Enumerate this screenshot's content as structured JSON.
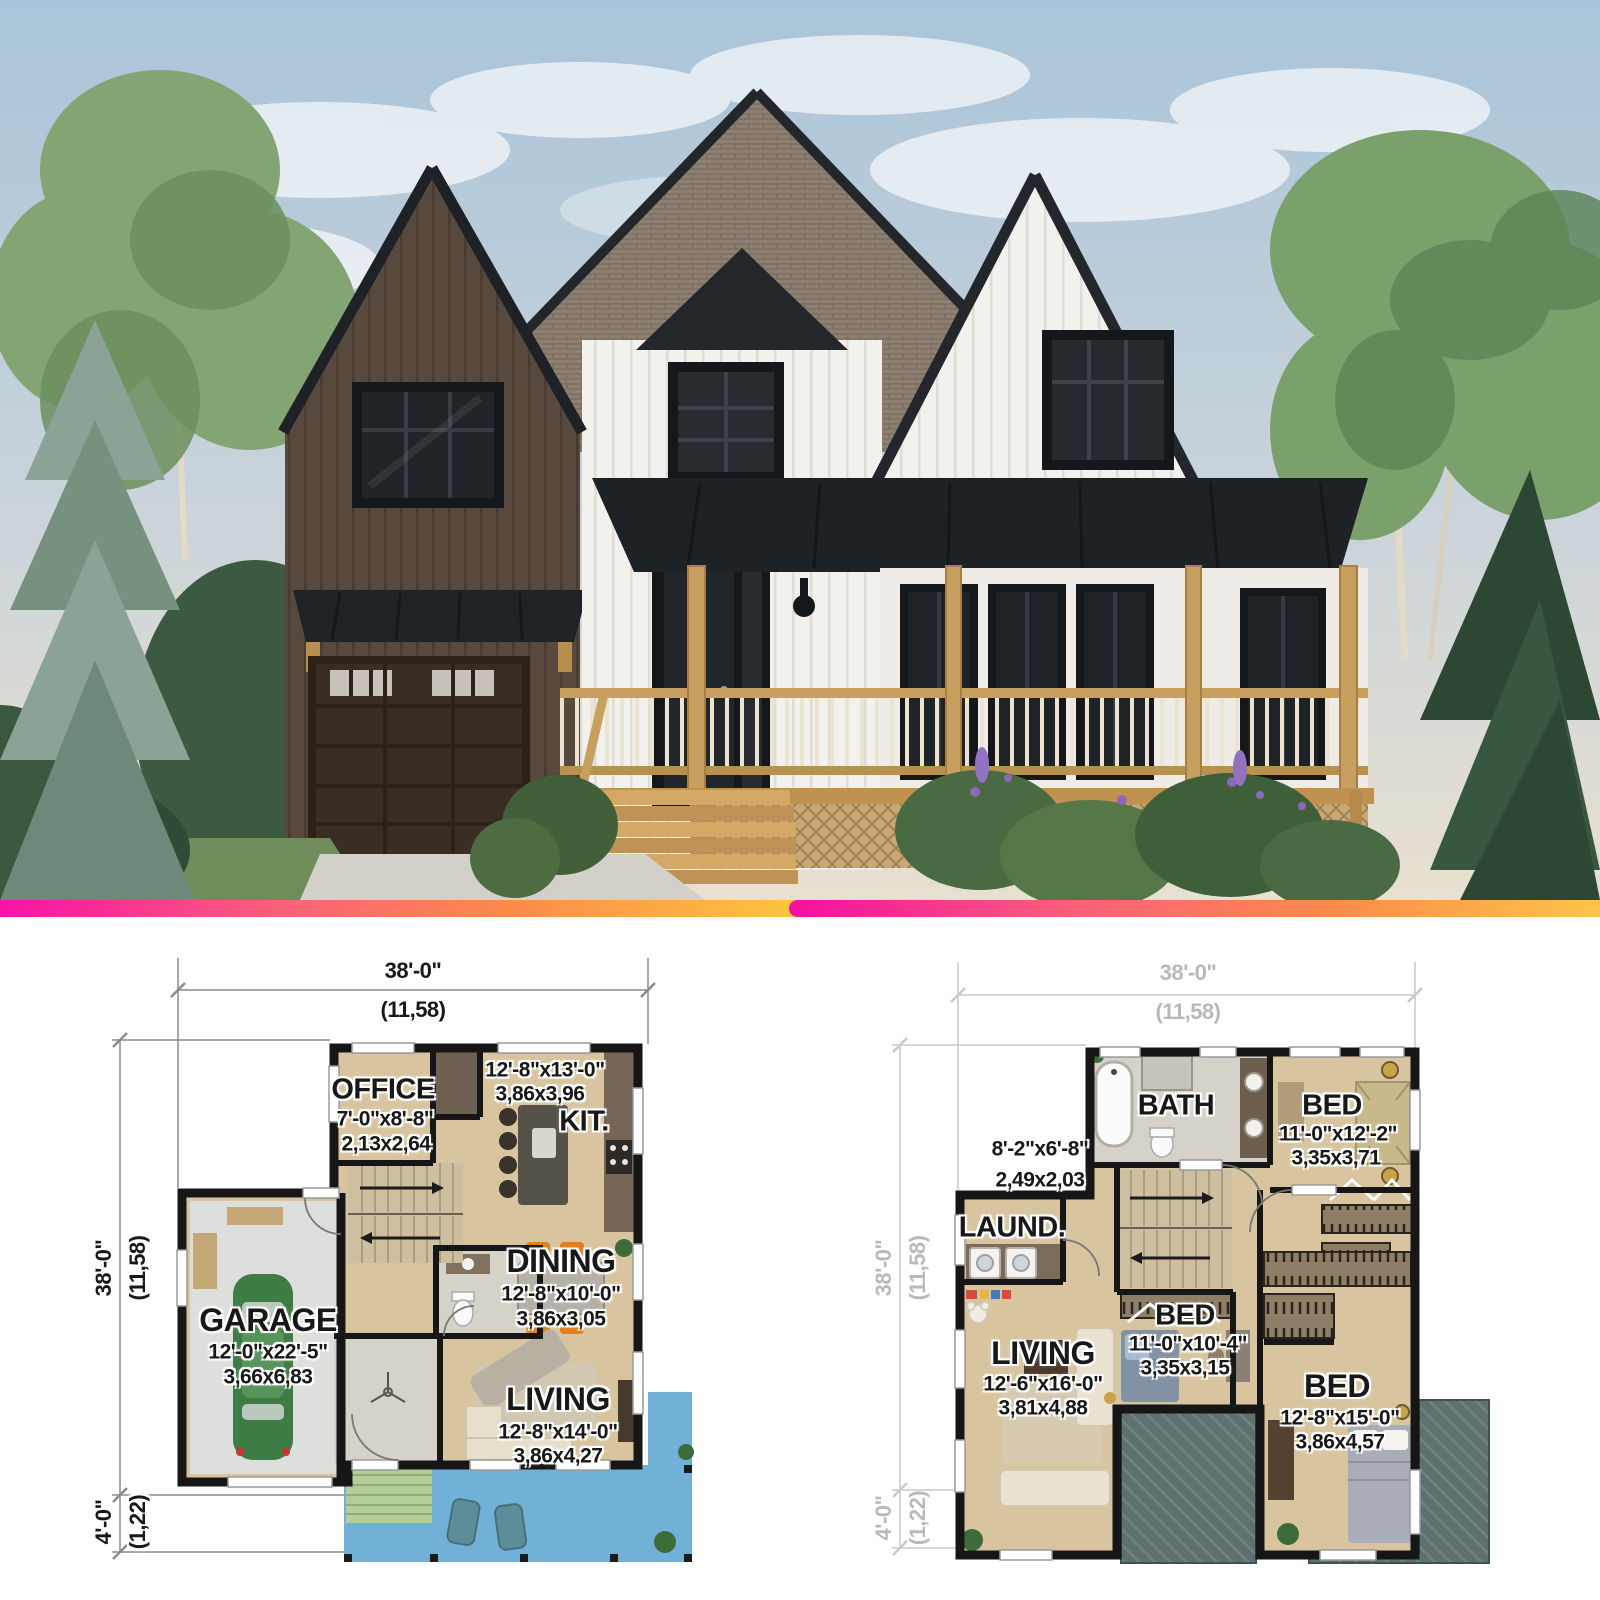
{
  "divider": {
    "color_start": "#fa12a6",
    "color_mid": "#fb8c4a",
    "color_end": "#fdc53e"
  },
  "photo": {
    "scene": "two-storey modern farmhouse exterior",
    "palette": {
      "sky": "#b0c8da",
      "dark_siding": "#57493d",
      "white_siding": "#f3f1ed",
      "roof_shingle": "#8d8071",
      "metal_roof": "#1d2226",
      "porch_wood": "#c79f5e",
      "garage_door": "#3a2e24"
    }
  },
  "plan_first": {
    "dims": {
      "width_ft": "38'-0\"",
      "width_m": "(11,58)",
      "depth_ft": "38'-0\"",
      "depth_m": "(11,58)",
      "deck_ft": "4'-0\"",
      "deck_m": "(1,22)"
    },
    "rooms": {
      "office": {
        "label": "OFFICE",
        "ft": "7'-0\"x8'-8\"",
        "m": "2,13x2,64"
      },
      "kitchen": {
        "label": "KIT.",
        "ft": "12'-8\"x13'-0\"",
        "m": "3,86x3,96"
      },
      "dining": {
        "label": "DINING",
        "ft": "12'-8\"x10'-0\"",
        "m": "3,86x3,05"
      },
      "living": {
        "label": "LIVING",
        "ft": "12'-8\"x14'-0\"",
        "m": "3,86x4,27"
      },
      "garage": {
        "label": "GARAGE",
        "ft": "12'-0\"x22'-5\"",
        "m": "3,66x6,83"
      }
    }
  },
  "plan_second": {
    "dims": {
      "width_ft": "38'-0\"",
      "width_m": "(11,58)",
      "depth_ft": "38'-0\"",
      "depth_m": "(11,58)",
      "deck_ft": "4'-0\"",
      "deck_m": "(1,22)"
    },
    "hall": {
      "ft": "8'-2\"x6'-8\"",
      "m": "2,49x2,03"
    },
    "rooms": {
      "bath": {
        "label": "BATH"
      },
      "bed1": {
        "label": "BED",
        "ft": "11'-0\"x12'-2\"",
        "m": "3,35x3,71"
      },
      "laundry": {
        "label": "LAUND."
      },
      "living": {
        "label": "LIVING",
        "ft": "12'-6\"x16'-0\"",
        "m": "3,81x4,88"
      },
      "bed2": {
        "label": "BED",
        "ft": "11'-0\"x10'-4\"",
        "m": "3,35x3,15"
      },
      "bed3": {
        "label": "BED",
        "ft": "12'-8\"x15'-0\"",
        "m": "3,86x4,57"
      }
    }
  }
}
